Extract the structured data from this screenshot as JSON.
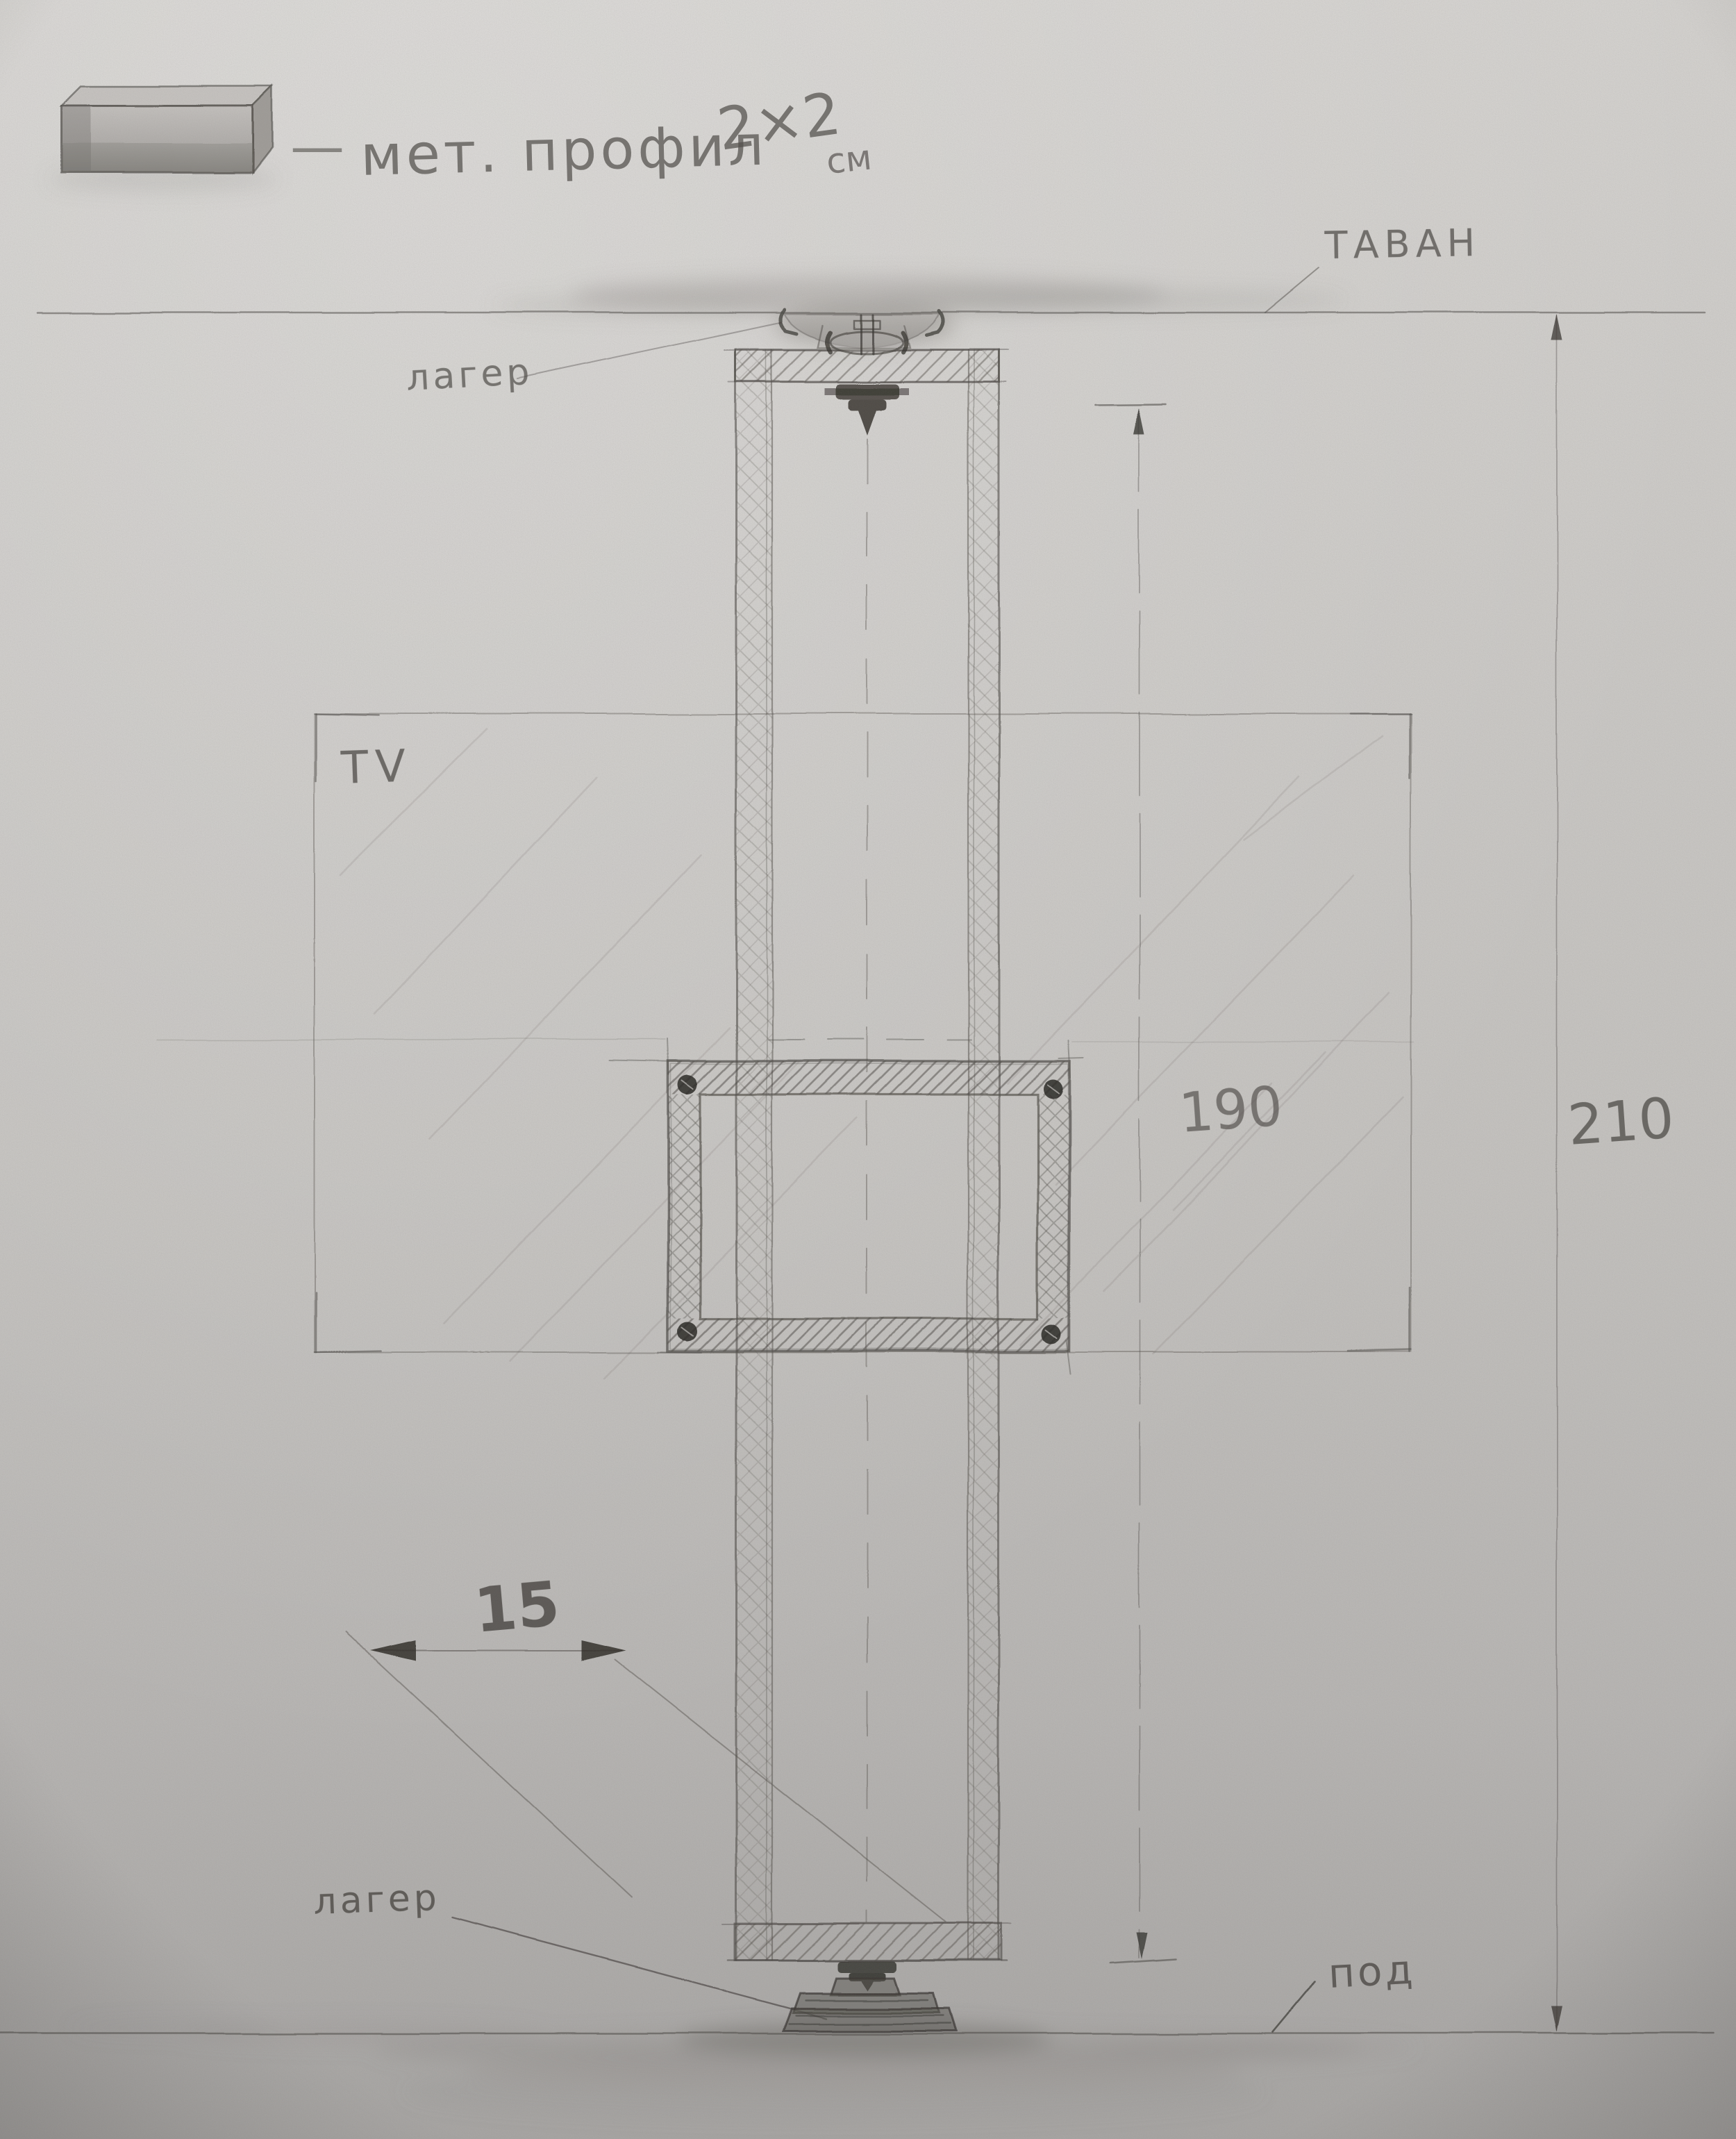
{
  "legend": {
    "dash": "—",
    "label": "мет. профил",
    "size": "2×2",
    "unit": "см"
  },
  "labels": {
    "ceiling": "ТАВАН",
    "bearing_top": "лагер",
    "tv": "TV",
    "bearing_bottom": "лагер",
    "floor": "под"
  },
  "dimensions": {
    "frame_height": "190",
    "ceiling_to_floor": "210",
    "frame_width": "15"
  },
  "colors": {
    "paper": "#c8c6c3",
    "graphite": "#4e4b47",
    "dark_graphite": "#2d2a26"
  }
}
